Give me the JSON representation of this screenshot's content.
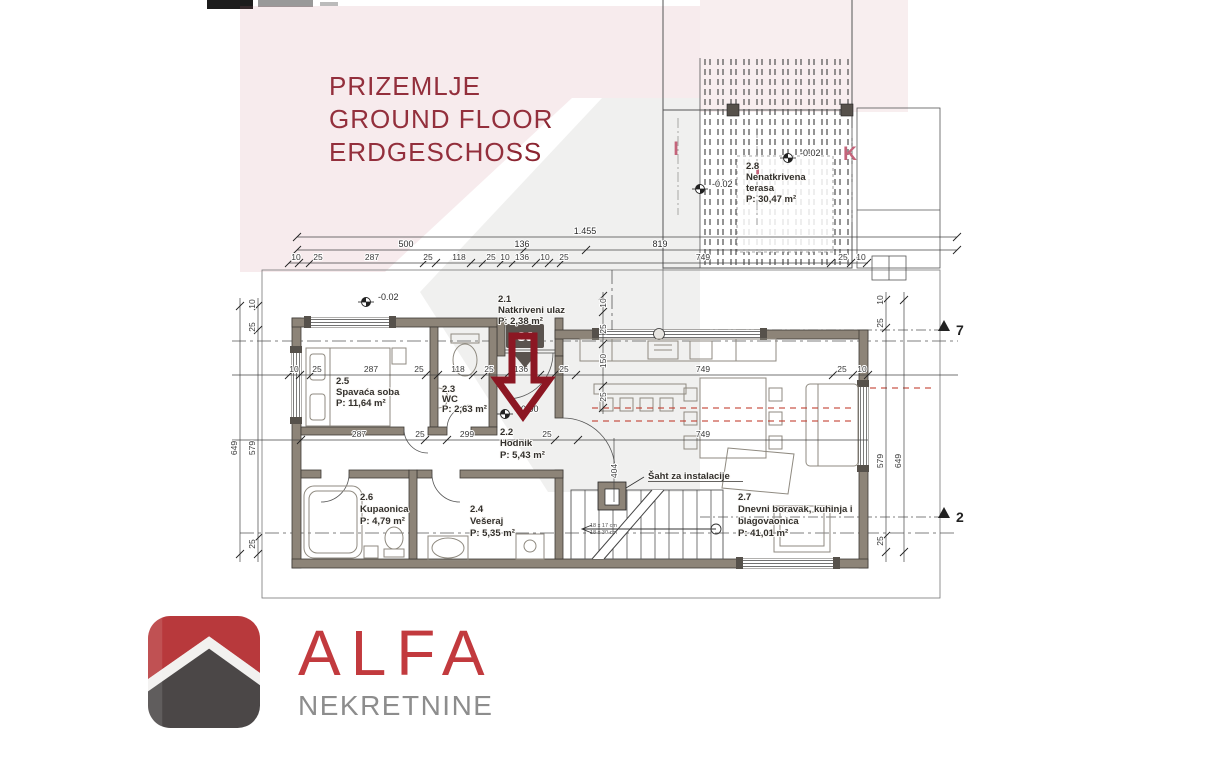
{
  "title": {
    "l1": "PRIZEMLJE",
    "l2": "GROUND FLOOR",
    "l3": "ERDGESCHOSS"
  },
  "rooms": {
    "r21": {
      "id": "2.1",
      "name": "Natkriveni ulaz",
      "area": "P: 2,38 m²"
    },
    "r22": {
      "id": "2.2",
      "name": "Hodnik",
      "area": "P: 5,43 m²"
    },
    "r23": {
      "id": "2.3",
      "name": "WC",
      "area": "P: 2,63 m²"
    },
    "r24": {
      "id": "2.4",
      "name": "Vešeraj",
      "area": "P: 5,35 m²"
    },
    "r25": {
      "id": "2.5",
      "name": "Spavaća soba",
      "area": "P: 11,64 m²"
    },
    "r26": {
      "id": "2.6",
      "name": "Kupaonica",
      "area": "P: 4,79 m²"
    },
    "r27": {
      "id": "2.7",
      "name": "Dnevni boravak, kuhinja i",
      "name2": "blagovaonica",
      "area": "P: 41,01 m²"
    },
    "r28": {
      "id": "2.8",
      "name": "Nenatkrivena",
      "name2": "terasa",
      "area": "P: 30,47 m²"
    }
  },
  "annotations": {
    "shaft": "Šaht za instalacije",
    "north": "SJ",
    "elev_zero": "±0,00",
    "elev_minus": "-0.02",
    "stair_note1": "18 x 17 cm",
    "stair_note2": "18 x 30 cm"
  },
  "grid_axes": {
    "a1": "I",
    "a2": "J",
    "a3": "K"
  },
  "sections": {
    "top": "7",
    "bottom": "2"
  },
  "dims": {
    "total": "1.455",
    "row2": [
      "500",
      "136",
      "819"
    ],
    "row3": [
      "10",
      "25",
      "287",
      "25",
      "118",
      "25",
      "10",
      "136",
      "10",
      "25",
      "749",
      "25",
      "10"
    ],
    "mid": [
      "10",
      "25",
      "287",
      "25",
      "118",
      "25",
      "136",
      "25",
      "749",
      "25",
      "10"
    ],
    "low": [
      "287",
      "25",
      "299",
      "25",
      "749"
    ],
    "entry": [
      "10",
      "25",
      "150",
      "25"
    ],
    "stair": "404",
    "vert": {
      "v649": "649",
      "v579": "579",
      "v25": "25",
      "v10": "10"
    }
  },
  "logo": {
    "brand": "ALFA",
    "tagline": "NEKRETNINE"
  },
  "colors": {
    "title_red": "#8b2531",
    "arrow_red": "#8c1723",
    "wall_grey": "#8d8478",
    "grid_pink": "#c4647a",
    "logo_red": "#c23a3e",
    "logo_dark": "#4b4747",
    "logo_text_grey": "#8d8d8d",
    "dash_red": "#c0392b"
  }
}
